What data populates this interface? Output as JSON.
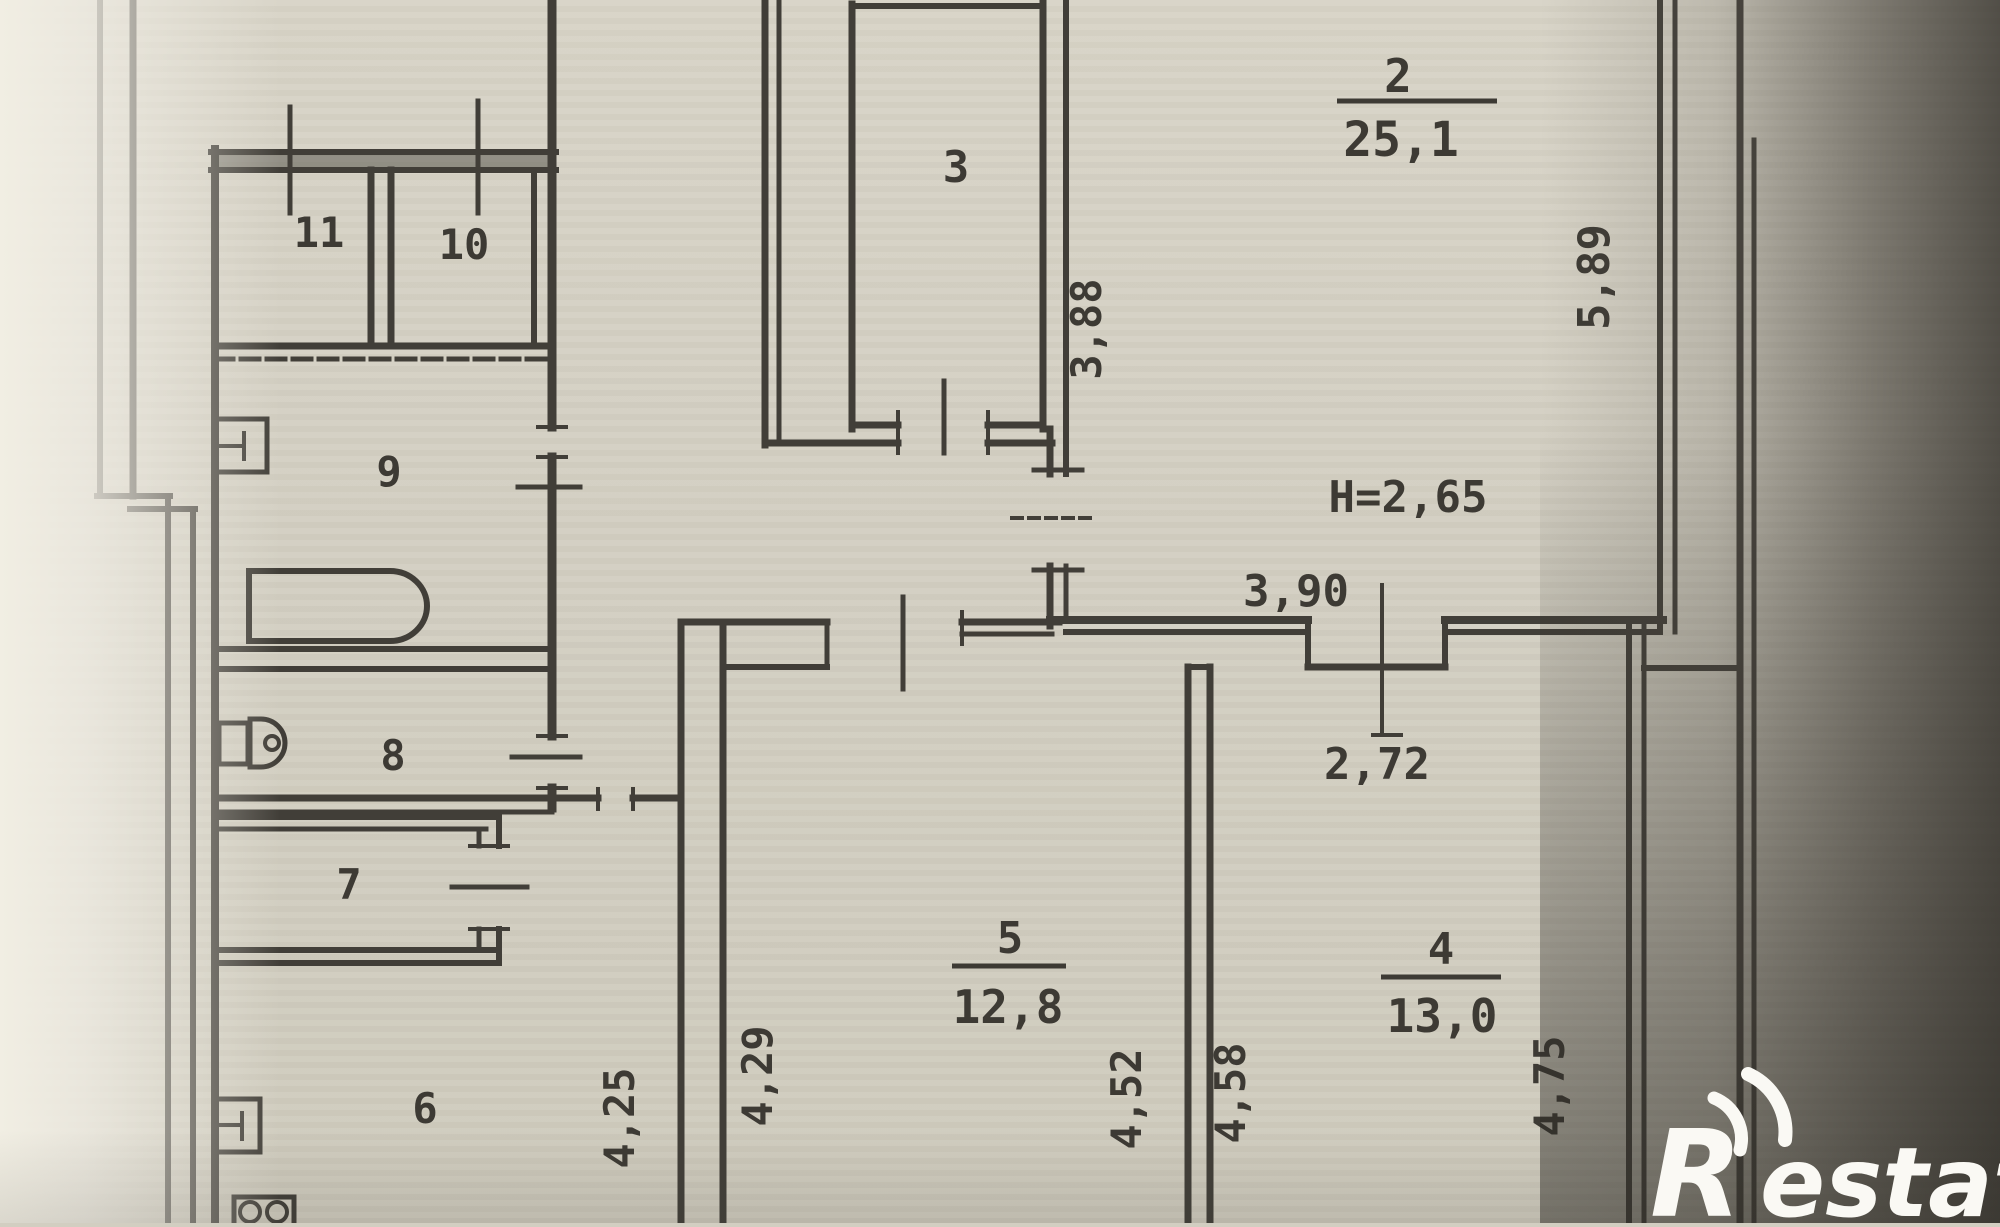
{
  "plan": {
    "type": "apartment floor plan (scanned)",
    "rooms": {
      "r2": {
        "number": "2",
        "area": "25,1"
      },
      "r3": {
        "number": "3"
      },
      "r4": {
        "number": "4",
        "area": "13,0"
      },
      "r5": {
        "number": "5",
        "area": "12,8"
      },
      "r6": {
        "number": "6"
      },
      "r7": {
        "number": "7"
      },
      "r8": {
        "number": "8"
      },
      "r9": {
        "number": "9"
      },
      "r10": {
        "number": "10"
      },
      "r11": {
        "number": "11"
      }
    },
    "dims": {
      "ceiling": "H=2,65",
      "d589": "5,89",
      "d388": "3,88",
      "d390": "3,90",
      "d272": "2,72",
      "d425": "4,25",
      "d429": "4,29",
      "d452": "4,52",
      "d458": "4,58",
      "d475": "4,75"
    },
    "fixtures": [
      "bathtub",
      "toilet",
      "washbasin",
      "kitchen-sink",
      "stove"
    ],
    "colors": {
      "paper": "#d3cfc2",
      "ink": "#413e38",
      "photo_shadow": "#3c3933",
      "logo": "#faf9f4"
    }
  },
  "watermark": {
    "initial": "R",
    "rest": "estate"
  }
}
